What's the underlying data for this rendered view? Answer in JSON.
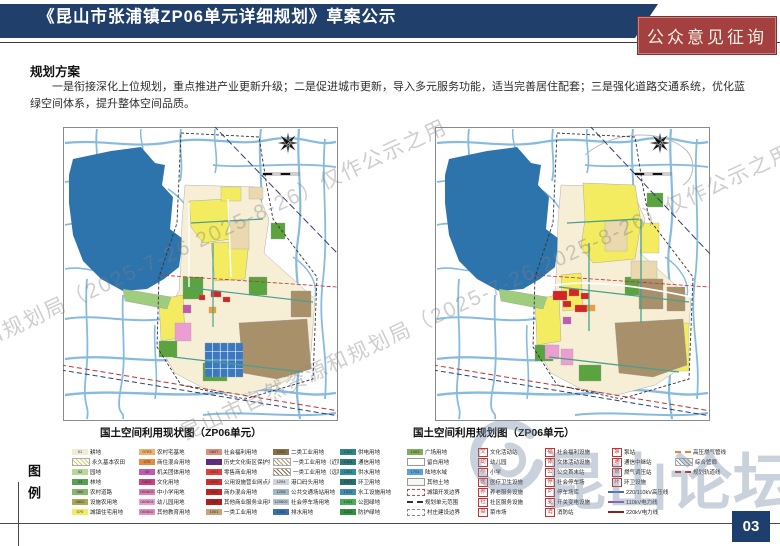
{
  "header": {
    "title": "《昆山市张浦镇ZP06单元详细规划》草案公示",
    "badge": "公众意见征询"
  },
  "section": {
    "heading": "规划方案",
    "paragraph": "一是衔接深化上位规划，重点推进产业更新升级；二是促进城市更新，导入多元服务功能，适当完善居住配套；三是强化道路交通系统，优化蓝绿空间体系，提升整体空间品质。"
  },
  "maps": [
    {
      "caption": "国土空间利用现状图（ZP06单元）"
    },
    {
      "caption": "国土空间利用规划图（ZP06单元）"
    }
  ],
  "legend": {
    "label": "图例",
    "columns": [
      [
        {
          "c": "01",
          "t": "耕地",
          "s": "fill",
          "col": "#f0ecd1"
        },
        {
          "t": "永久基本农田",
          "s": "hatch",
          "col": "#cfd06a"
        },
        {
          "c": "02",
          "t": "园地",
          "s": "fill",
          "col": "#b9d798"
        },
        {
          "c": "03",
          "t": "林地",
          "s": "fill",
          "col": "#55a054"
        },
        {
          "c": "060",
          "t": "农村道路",
          "s": "fill",
          "col": "#86b56d"
        },
        {
          "c": "0602",
          "t": "设施农用地",
          "s": "fill",
          "col": "#a9a953"
        },
        {
          "c": "070",
          "t": "城镇住宅用地",
          "s": "fill",
          "col": "#f3ec61"
        }
      ],
      [
        {
          "c": "0703",
          "t": "农村宅基地",
          "s": "fill",
          "col": "#f0b26a"
        },
        {
          "c": "075",
          "t": "商住混合用地",
          "s": "fill",
          "col": "#e78b3f"
        },
        {
          "c": "08",
          "t": "机关团体用地",
          "s": "fill",
          "col": "#c05ab2"
        },
        {
          "c": "0802",
          "t": "文化用地",
          "s": "fill",
          "col": "#c9417f"
        },
        {
          "c": "080803",
          "t": "中小学用地",
          "s": "fill",
          "col": "#e07fb4"
        },
        {
          "c": "080804",
          "t": "幼儿园用地",
          "s": "fill",
          "col": "#ef9ccd"
        },
        {
          "c": "080802",
          "t": "其他教育用地",
          "s": "fill",
          "col": "#e98fc0"
        }
      ],
      [
        {
          "c": "0807",
          "t": "社会福利用地",
          "s": "fill",
          "col": "#dd907c"
        },
        {
          "t": "历史文化街区保护控制范围",
          "s": "fill",
          "col": "#5c2d7e"
        },
        {
          "c": "0901",
          "t": "零售商业用地",
          "s": "fill",
          "col": "#e4403a"
        },
        {
          "c": "0906",
          "t": "公用设施营业网点用地",
          "s": "fill",
          "col": "#d12f2f"
        },
        {
          "c": "0902",
          "t": "商办混合用地",
          "s": "fill",
          "col": "#c32424"
        },
        {
          "c": "0905",
          "t": "其他商业服务业用地",
          "s": "fill",
          "col": "#b21d1d"
        },
        {
          "c": "1001",
          "t": "一类工业用地",
          "s": "fill",
          "col": "#c7a37b"
        }
      ],
      [
        {
          "c": "1002",
          "t": "二类工业用地",
          "s": "fill",
          "col": "#8a6f48"
        },
        {
          "t": "一类工业用地（近期更新）",
          "s": "hatch",
          "col": "#b09a70"
        },
        {
          "t": "一类工业用地（远期更新）",
          "s": "hatch",
          "col": "#8a6f48"
        },
        {
          "c": "1204",
          "t": "港口码头用地",
          "s": "fill",
          "col": "#cfd4dd"
        },
        {
          "c": "1208",
          "t": "公共交通场站用地",
          "s": "fill",
          "col": "#9fb6c9"
        },
        {
          "c": "120802",
          "t": "社会停车场用地",
          "s": "fill",
          "col": "#b7c6d6"
        },
        {
          "c": "1306",
          "t": "排水用地",
          "s": "fill",
          "col": "#3a6fb0"
        }
      ],
      [
        {
          "c": "1302",
          "t": "供电用地",
          "s": "fill",
          "col": "#2e8585"
        },
        {
          "c": "1304",
          "t": "通信用地",
          "s": "fill",
          "col": "#2a7a7a"
        },
        {
          "c": "1301",
          "t": "供水用地",
          "s": "fill",
          "col": "#2f8f9a"
        },
        {
          "c": "1307",
          "t": "环卫用地",
          "s": "fill",
          "col": "#276f6f"
        },
        {
          "c": "1312",
          "t": "水工设施用地",
          "s": "fill",
          "col": "#3e8fae"
        },
        {
          "c": "1401",
          "t": "公园绿地",
          "s": "fill",
          "col": "#47ad57"
        },
        {
          "c": "1402",
          "t": "防护绿地",
          "s": "fill",
          "col": "#2f8f43"
        }
      ],
      [
        {
          "c": "1403",
          "t": "广场用地",
          "s": "fill",
          "col": "#7fae5c"
        },
        {
          "t": "留白用地",
          "s": "fill",
          "col": "#ffffff"
        },
        {
          "c": "1701",
          "t": "陆地水域",
          "s": "fill",
          "col": "#5aa0d8"
        },
        {
          "t": "其他土地",
          "s": "fill",
          "col": "#f7f7f7"
        },
        {
          "t": "城镇开发边界",
          "s": "box",
          "col": "#d04040"
        },
        {
          "t": "规划单元范围",
          "s": "line",
          "col": "#333333",
          "dash": true
        },
        {
          "t": "村庄建设边界",
          "s": "box",
          "col": "#888888"
        }
      ],
      [
        {
          "g": "文",
          "n": "culture-station",
          "t": "文化活动站",
          "s": "icon"
        },
        {
          "g": "幼",
          "n": "kindergarten",
          "t": "幼儿园",
          "s": "icon"
        },
        {
          "g": "小",
          "n": "primary-school",
          "t": "小学",
          "s": "icon"
        },
        {
          "g": "医",
          "n": "clinic",
          "t": "医疗卫生设施",
          "s": "icon"
        },
        {
          "g": "养",
          "n": "elderly-care",
          "t": "养老服务设施",
          "s": "icon"
        },
        {
          "g": "社",
          "n": "community-center",
          "t": "社区服务设施",
          "s": "icon"
        },
        {
          "g": "菜",
          "n": "market",
          "t": "菜市场",
          "s": "icon"
        }
      ],
      [
        {
          "g": "福",
          "n": "welfare",
          "t": "社会福利设施",
          "s": "icon"
        },
        {
          "g": "体",
          "n": "sports",
          "t": "文体活动设施",
          "s": "icon"
        },
        {
          "g": "公",
          "n": "bus-terminal",
          "t": "公交首末站",
          "s": "icon"
        },
        {
          "g": "停",
          "n": "parking",
          "t": "社会停车场",
          "s": "icon"
        },
        {
          "g": "P",
          "n": "parking-garage",
          "t": "停车场库",
          "s": "icon"
        },
        {
          "g": "变",
          "n": "substation",
          "t": "开关变电设施",
          "s": "icon"
        },
        {
          "g": "消",
          "n": "fire-station",
          "t": "消防站",
          "s": "icon"
        }
      ],
      [
        {
          "g": "泵",
          "n": "pump-station",
          "t": "泵站",
          "s": "icon"
        },
        {
          "g": "通",
          "n": "telecom",
          "t": "通信中继站",
          "s": "icon"
        },
        {
          "g": "燃",
          "n": "gas-station",
          "t": "燃气调压站",
          "s": "icon"
        },
        {
          "g": "环",
          "n": "sanitation",
          "t": "环卫设施",
          "s": "icon"
        },
        {
          "t": "220/110kV高压线",
          "s": "line",
          "col": "#4a6fb5"
        },
        {
          "t": "110kV电力线",
          "s": "line",
          "col": "#8855aa"
        },
        {
          "t": "220kV电力线",
          "s": "line",
          "col": "#8b2020"
        }
      ],
      [
        {
          "t": "高压燃气管线",
          "s": "line",
          "col": "#e08a30",
          "dash": true
        },
        {
          "t": "综合管廊",
          "s": "hatch",
          "col": "#999999"
        },
        {
          "t": "规划轨道线",
          "s": "line",
          "col": "#c03030",
          "dash": true
        }
      ]
    ]
  },
  "watermarks": {
    "agency": "昆山市自然资源和规划局（2025-7-26 2025-8-26）仅作公示之用",
    "forum": "昆山论坛"
  },
  "page_number": "03",
  "colors": {
    "header_navy": "#20406b",
    "badge_red": "#a54040",
    "lake_blue": "#2d74ad",
    "river_blue": "#86bbe0",
    "residential_yellow": "#f3ec61",
    "village_brown": "#a8906a",
    "page_bg": "#ffffff"
  }
}
